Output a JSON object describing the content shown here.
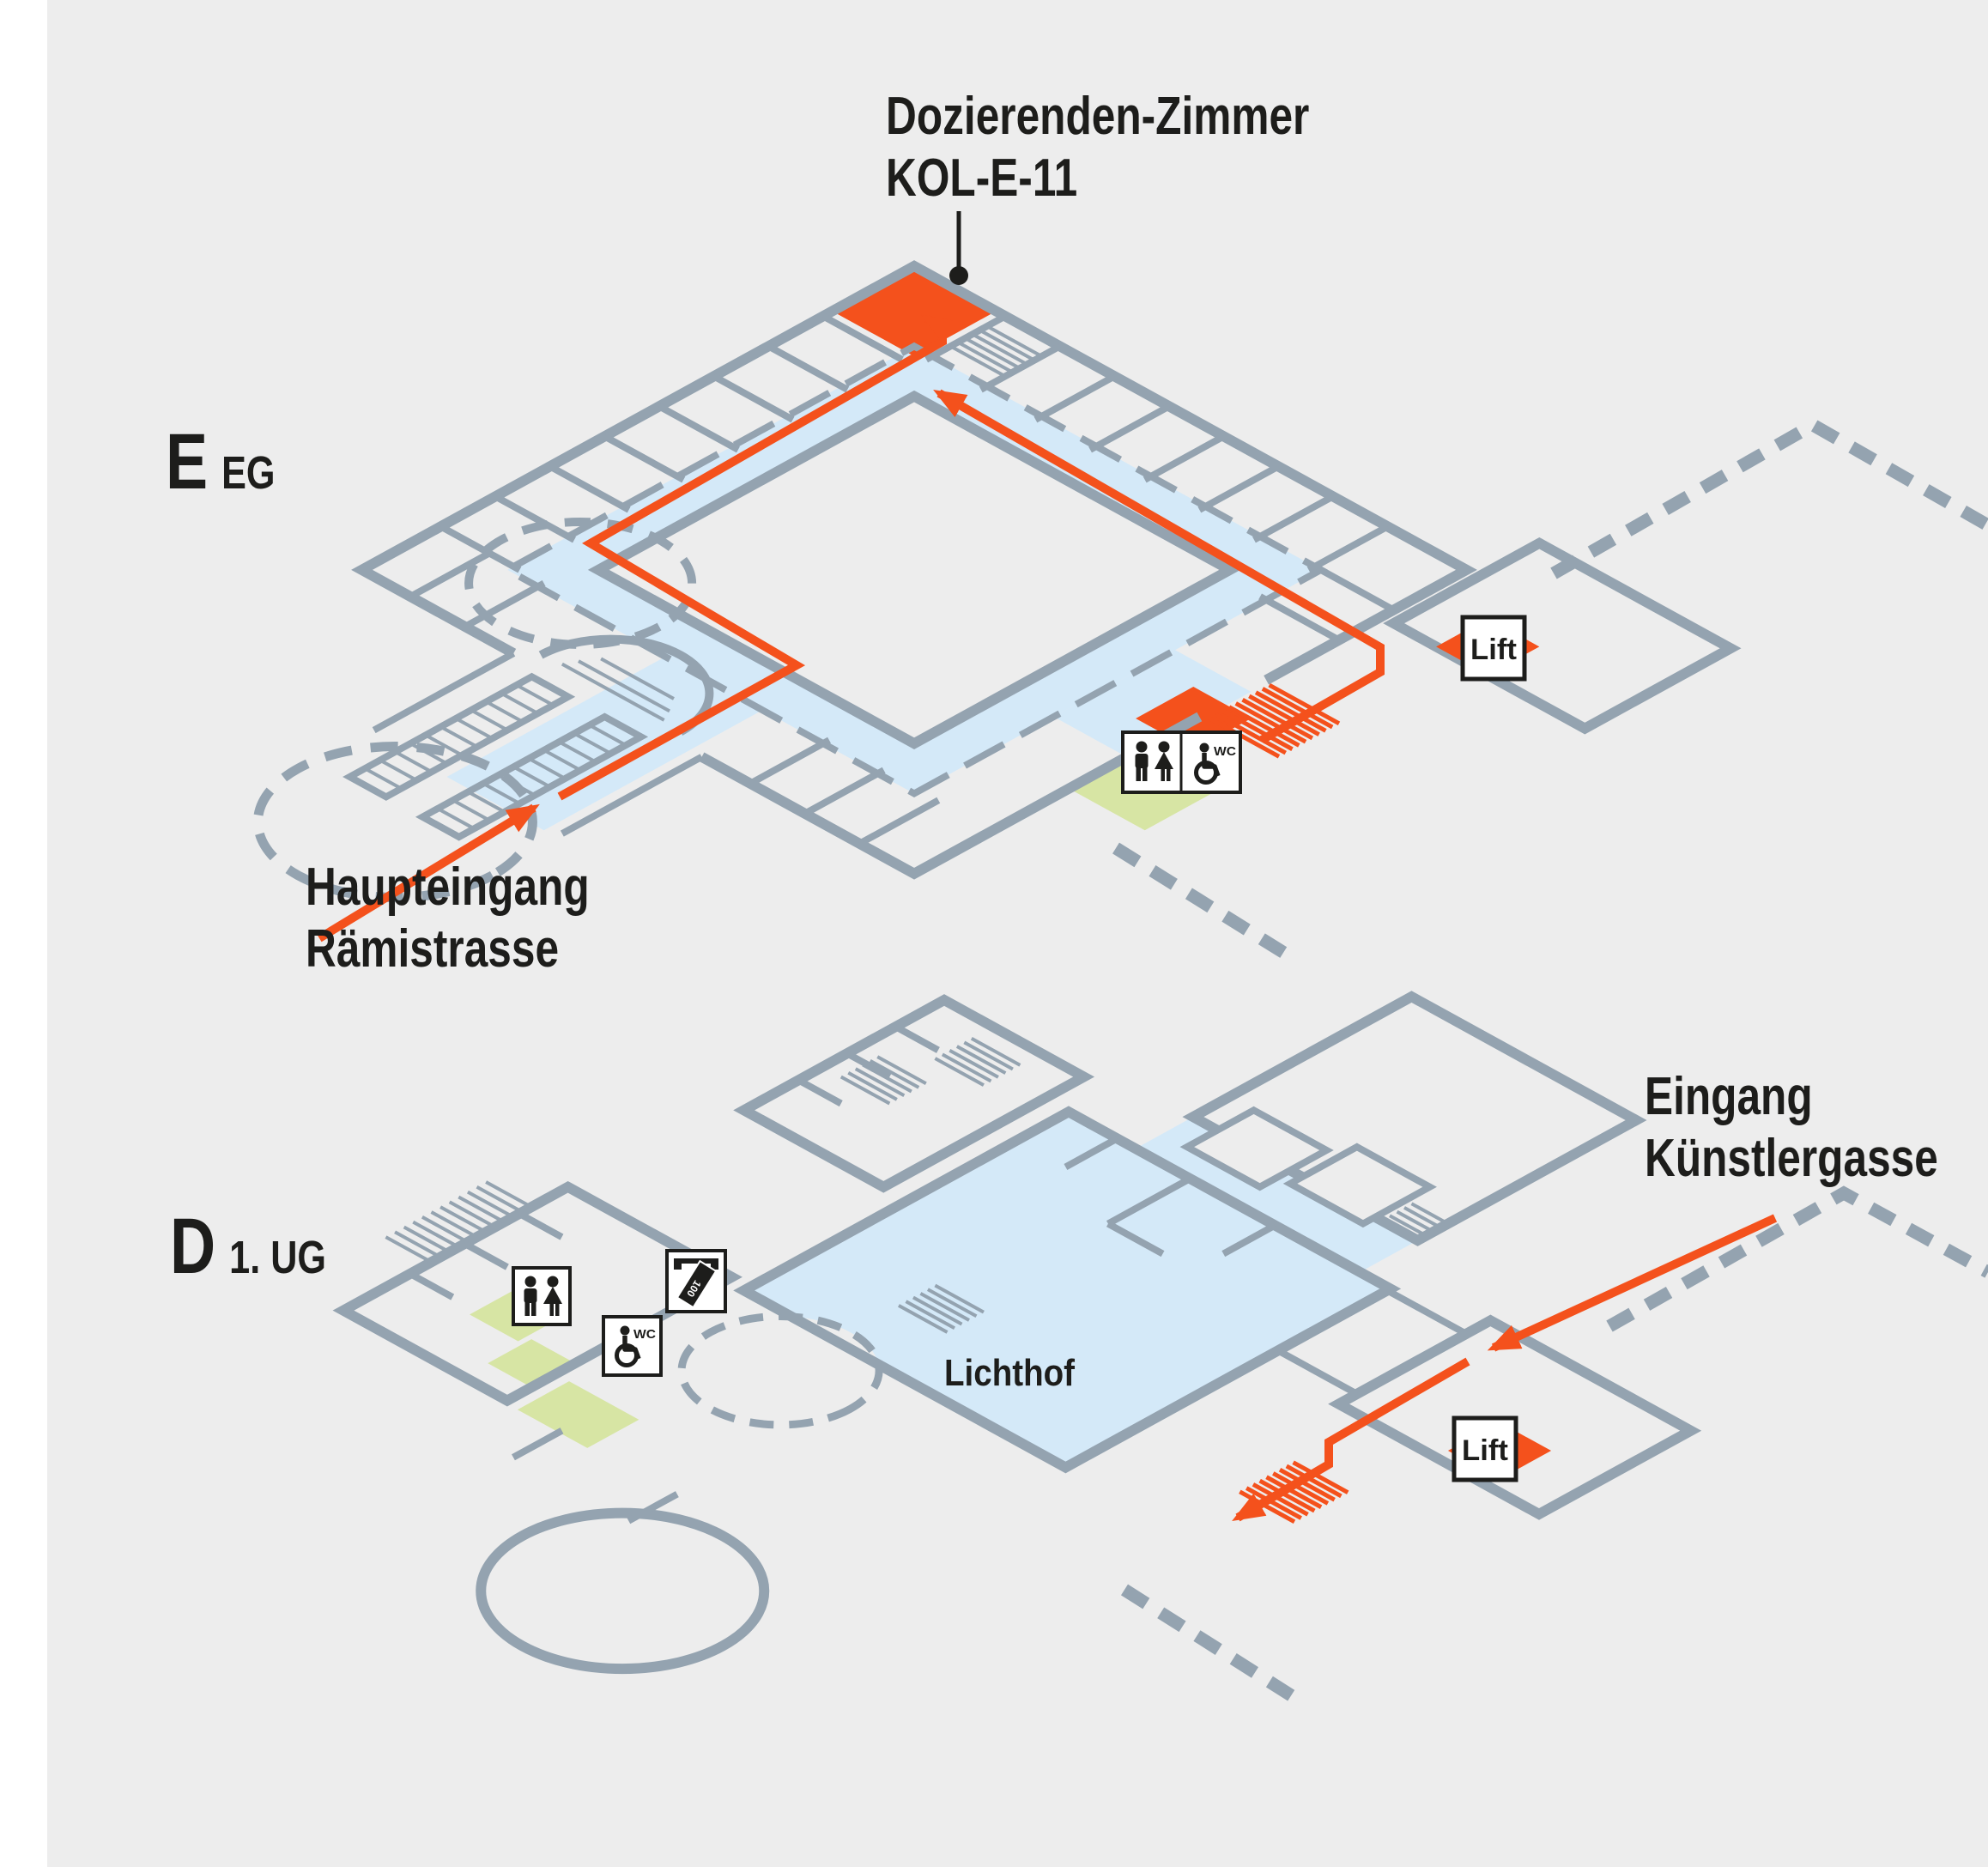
{
  "colors": {
    "page-bg": "#FFFFFF",
    "canvas": "#EDEDED",
    "wall": "#94A3B0",
    "corridor": "#D4E9F8",
    "highlight": "#F4511C",
    "accent-green": "#D7E5A4",
    "ink": "#1D1D1B",
    "box-bg": "#FFFFFF"
  },
  "floors": {
    "upper": {
      "code": "E",
      "level": "EG",
      "room": {
        "line1": "Dozierenden-Zimmer",
        "line2": "KOL-E-11"
      },
      "entrance": {
        "line1": "Haupteingang",
        "line2": "Rämistrasse"
      },
      "lift": "Lift",
      "wc": "WC"
    },
    "lower": {
      "code": "D",
      "level": "1. UG",
      "atrium": "Lichthof",
      "entrance": {
        "line1": "Eingang",
        "line2": "Künstlergasse"
      },
      "lift": "Lift",
      "wc": "WC",
      "banknote": "100"
    }
  },
  "icons": [
    "wc-men-women-icon",
    "wc-accessible-icon",
    "ticket-machine-icon",
    "lift-badge",
    "route-arrow",
    "stairs-hatch",
    "entrance-rotunda"
  ]
}
